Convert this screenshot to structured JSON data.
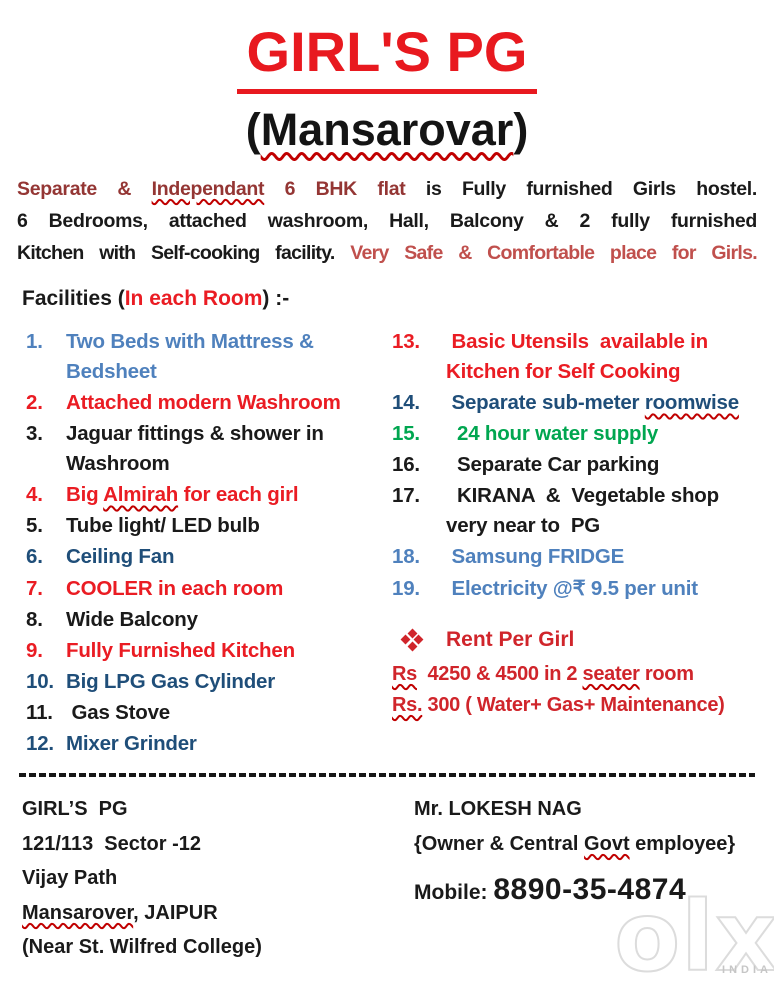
{
  "palette": {
    "title_red": "#e8191f",
    "red": "#ea1c23",
    "rent_red": "#d0252b",
    "maroon": "#943634",
    "brick": "#c0504d",
    "light_blue": "#4f81bd",
    "dark_blue": "#1f4e79",
    "green": "#00a650",
    "black": "#1a1a1a",
    "wavy_red": "#c00000"
  },
  "title": {
    "text": "GIRL'S  PG"
  },
  "subtitle": {
    "open": "(",
    "name": "Mansarovar",
    "close": ")"
  },
  "intro": {
    "lines": [
      {
        "segments": [
          {
            "t": "Separate & ",
            "color": "maroon"
          },
          {
            "t": "Independant",
            "color": "maroon",
            "wavy": true
          },
          {
            "t": " 6 BHK flat ",
            "color": "maroon"
          },
          {
            "t": "is Fully furnished Girls hostel."
          }
        ]
      },
      {
        "segments": [
          {
            "t": "6 Bedrooms, attached washroom, Hall, Balcony &  2 fully furnished"
          }
        ]
      },
      {
        "tight": true,
        "segments": [
          {
            "t": "Kitchen with Self-cooking facility. "
          },
          {
            "t": "Very Safe & Comfortable place for Girls.",
            "color": "brick"
          }
        ]
      }
    ]
  },
  "facilities": {
    "heading_segments": [
      {
        "t": "Facilities ("
      },
      {
        "t": "In each Room",
        "color": "red"
      },
      {
        "t": ") :-"
      }
    ],
    "left_items": [
      {
        "num": "1.",
        "color": "light_blue",
        "segments": [
          {
            "t": "Two Beds with Mattress &\nBedsheet"
          }
        ]
      },
      {
        "num": "2.",
        "color": "red",
        "segments": [
          {
            "t": "Attached modern Washroom"
          }
        ]
      },
      {
        "num": "3.",
        "color": "black",
        "segments": [
          {
            "t": "Jaguar fittings & shower in\nWashroom"
          }
        ]
      },
      {
        "num": "4.",
        "color": "red",
        "segments": [
          {
            "t": "Big "
          },
          {
            "t": "Almirah",
            "wavy": true
          },
          {
            "t": " for each girl"
          }
        ]
      },
      {
        "num": "5.",
        "color": "black",
        "segments": [
          {
            "t": "Tube light/ LED bulb"
          }
        ]
      },
      {
        "num": "6.",
        "color": "dark_blue",
        "segments": [
          {
            "t": "Ceiling Fan"
          }
        ]
      },
      {
        "num": "7.",
        "color": "red",
        "segments": [
          {
            "t": "COOLER in each room"
          }
        ]
      },
      {
        "num": "8.",
        "color": "black",
        "segments": [
          {
            "t": "Wide Balcony"
          }
        ]
      },
      {
        "num": "9.",
        "color": "red",
        "segments": [
          {
            "t": "Fully Furnished Kitchen"
          }
        ]
      },
      {
        "num": "10.",
        "color": "dark_blue",
        "segments": [
          {
            "t": "Big LPG Gas Cylinder"
          }
        ]
      },
      {
        "num": "11.",
        "color": "black",
        "segments": [
          {
            "t": " Gas Stove"
          }
        ]
      },
      {
        "num": "12.",
        "color": "dark_blue",
        "segments": [
          {
            "t": "Mixer Grinder"
          }
        ]
      }
    ],
    "right_items": [
      {
        "num": "13.",
        "color": "red",
        "segments": [
          {
            "t": " Basic Utensils  available in\nKitchen for Self Cooking"
          }
        ]
      },
      {
        "num": "14.",
        "color": "dark_blue",
        "segments": [
          {
            "t": " Separate sub-meter "
          },
          {
            "t": "roomwise",
            "wavy": true
          }
        ]
      },
      {
        "num": "15.",
        "color": "green",
        "segments": [
          {
            "t": "  24 hour water supply"
          }
        ]
      },
      {
        "num": "16.",
        "color": "black",
        "segments": [
          {
            "t": "  Separate Car parking"
          }
        ]
      },
      {
        "num": "17.",
        "color": "black",
        "segments": [
          {
            "t": "  KIRANA  &  Vegetable shop\nvery near to  PG"
          }
        ]
      },
      {
        "num": "18.",
        "color": "light_blue",
        "segments": [
          {
            "t": " Samsung FRIDGE"
          }
        ]
      },
      {
        "num": "19.",
        "color": "light_blue",
        "segments": [
          {
            "t": " Electricity @₹ 9.5 per unit"
          }
        ]
      }
    ]
  },
  "rent": {
    "bullet_icon": "four-diamond-icon",
    "heading": "Rent Per Girl",
    "lines": [
      {
        "segments": [
          {
            "t": "Rs",
            "wavy": true
          },
          {
            "t": "  4250 & 4500 in 2 "
          },
          {
            "t": "seater",
            "wavy": true
          },
          {
            "t": " room"
          }
        ]
      },
      {
        "segments": [
          {
            "t": "Rs.",
            "wavy": true
          },
          {
            "t": " 300 ( Water+ Gas+ Maintenance)"
          }
        ]
      }
    ]
  },
  "footer": {
    "address_lines": [
      {
        "segments": [
          {
            "t": "GIRL’S  PG"
          }
        ]
      },
      {
        "segments": [
          {
            "t": "121/113  Sector -12"
          }
        ]
      },
      {
        "segments": [
          {
            "t": "Vijay Path"
          }
        ]
      },
      {
        "segments": [
          {
            "t": "Mansarover",
            "wavy": true
          },
          {
            "t": ", JAIPUR"
          }
        ]
      },
      {
        "segments": [
          {
            "t": "(Near St. Wilfred College)"
          }
        ]
      }
    ],
    "contact": {
      "name": "Mr. LOKESH NAG",
      "role_segments": [
        {
          "t": "{Owner & Central "
        },
        {
          "t": "Govt",
          "wavy": true
        },
        {
          "t": " employee}"
        }
      ],
      "phone_segments": [
        {
          "t": "Mobile: ",
          "cls": "phone-label"
        },
        {
          "t": "8890-35-4874",
          "cls": "phone-number"
        }
      ]
    }
  },
  "watermark": {
    "text": "olx",
    "sub": "INDIA"
  }
}
